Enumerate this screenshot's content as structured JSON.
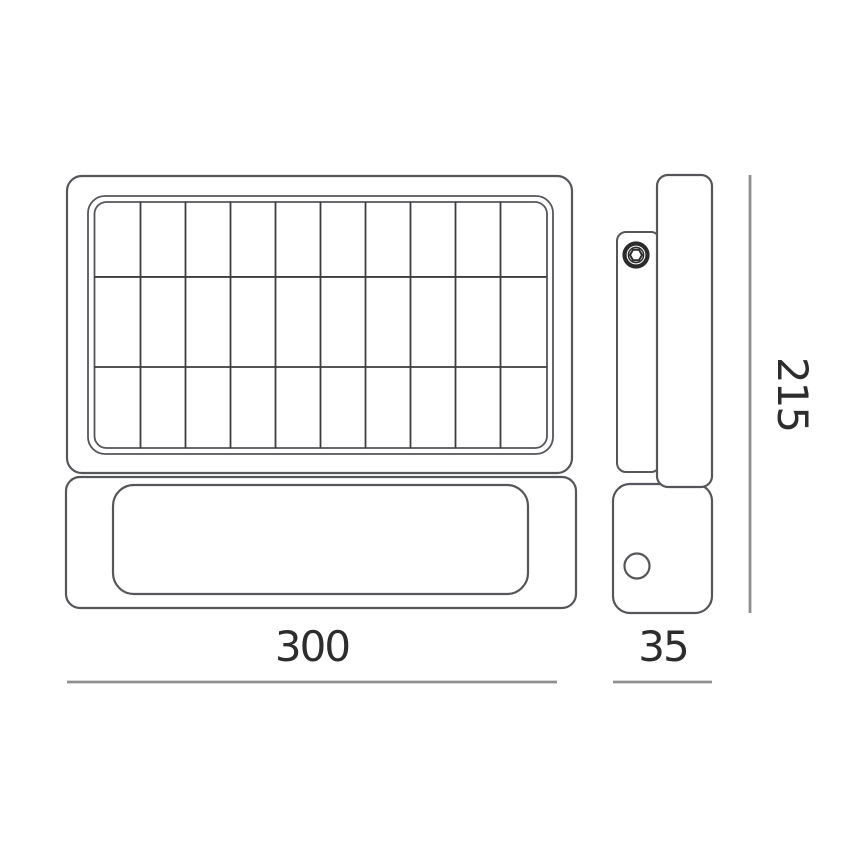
{
  "diagram": {
    "type": "technical-drawing",
    "views": {
      "front": {
        "grid": {
          "columns": 10,
          "rows": 3
        }
      }
    },
    "dimensions": {
      "width_mm": "300",
      "depth_mm": "35",
      "height_mm": "215"
    },
    "colors": {
      "background": "#ffffff",
      "outline": "#55565a",
      "grid_line": "#3d3d3d",
      "bolt": "#2b2b2b",
      "dimension_line": "#909090",
      "text": "#2d2d2d"
    }
  }
}
